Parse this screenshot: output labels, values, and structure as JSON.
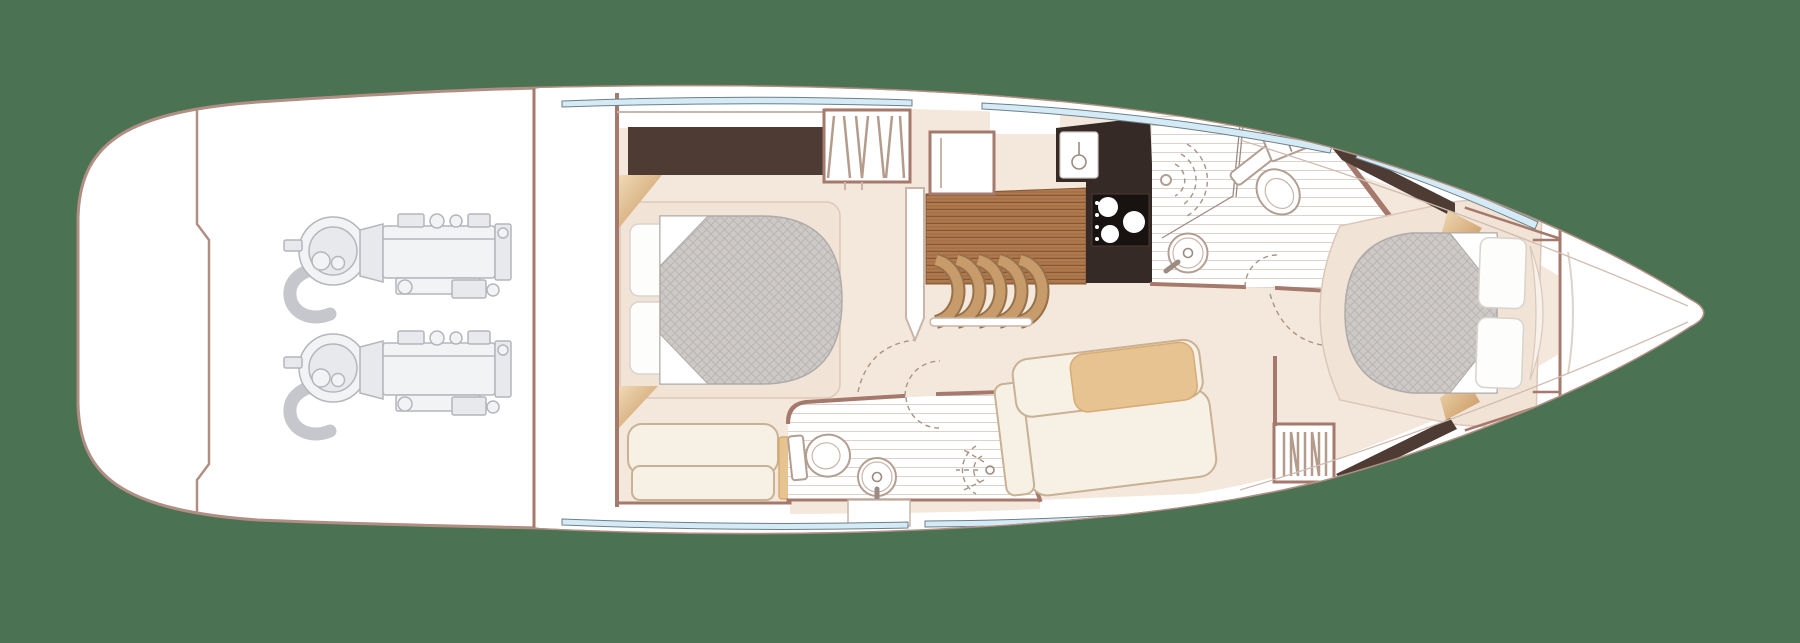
{
  "diagram": {
    "type": "yacht-lower-deck-floor-plan",
    "colors": {
      "background": "#4b7353",
      "hullStroke": "#b18e83",
      "wall": "#a5796c",
      "wallLight": "#c9b6a8",
      "floor": "#f4e8dc",
      "floorShade": "#f1e3d6",
      "platformEdge": "#dcc8b8",
      "darkWood": "#4e3b33",
      "counter": "#362a27",
      "hob": "#181211",
      "teak": "#b07a4e",
      "plankLine": "#845836",
      "stepWood": "#c89c6a",
      "stepDark": "#97714a",
      "windowBlue": "#d4eaf5",
      "windowStroke": "#6d7f8a",
      "mattress": "#cdc9c7",
      "mattressLine": "#b7b2b0",
      "mattressEdge": "#aeaaa8",
      "pillow": "#fdfdfb",
      "pillowStroke": "#d9d3cd",
      "sofa": "#f6f0e5",
      "sofaStroke": "#c9b194",
      "cushionTan": "#e8c392",
      "cushionStroke": "#d8ab72",
      "engine": "#b4b6bc",
      "engineFill": "#f2f3f5",
      "tile": "#ddd3ca",
      "dash": "#a89384",
      "glass": "#9b8b80",
      "fixtureStroke": "#b39e92"
    },
    "features": [
      "swim-platform",
      "engine-room",
      "twin-engines",
      "mid-cabin-double-berth",
      "mid-cabin-sofa",
      "hanging-locker",
      "companionway-stairs",
      "galley-counter",
      "galley-sink",
      "galley-hob",
      "day-head-shower",
      "day-head-toilet",
      "day-head-basin",
      "ensuite-toilet",
      "ensuite-basin",
      "ensuite-shower",
      "saloon-sofa",
      "forward-double-berth",
      "hull-windows",
      "forepeak"
    ]
  }
}
